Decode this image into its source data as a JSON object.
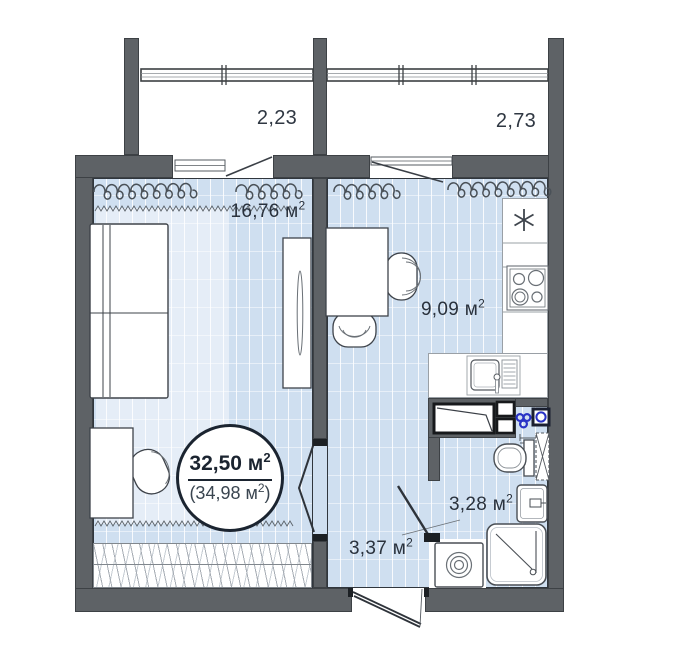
{
  "meta": {
    "type": "apartment-floor-plan"
  },
  "labels": {
    "balcony_left": "2,23",
    "balcony_right": "2,73",
    "living_room": {
      "text": "16,76 м",
      "sup": "2"
    },
    "kitchen": {
      "text": "9,09 м",
      "sup": "2"
    },
    "bathroom": {
      "text": "3,28 м",
      "sup": "2"
    },
    "hallway": {
      "text": "3,37 м",
      "sup": "2"
    },
    "total_area": {
      "text": "32,50 м",
      "sup": "2"
    },
    "total_area_alt": {
      "pre": "(34,98 м",
      "sup": "2",
      "post": ")"
    }
  },
  "icons": {
    "fridge_marker": "asterisk",
    "stove": "four-burner-circles",
    "kitchen_sink": "basin-with-drainer",
    "washing_machine": "square-with-drum-rings",
    "shower": "rounded-square-diagonal-drain",
    "toilet": "bowl-with-tank",
    "bathroom_sink": "rounded-basin-with-faucet",
    "towel_dryer": "dashed-x-rect",
    "ventilation_fan": "three-blue-circles",
    "water_meter": "blue-circle-in-box",
    "vent_shaft": "small-black-bordered-squares",
    "curtains": "coil-squiggle",
    "wardrobe": "hatched-strip",
    "doors": "swing-leaf-lines"
  },
  "colors": {
    "wall": "#5e6266",
    "floor": "#cfdff0",
    "rug": "#e3ecf7",
    "line": "#3e434a",
    "accent_blue": "#2832c6",
    "text": "#2a323d",
    "badge_border": "#1b2430"
  }
}
